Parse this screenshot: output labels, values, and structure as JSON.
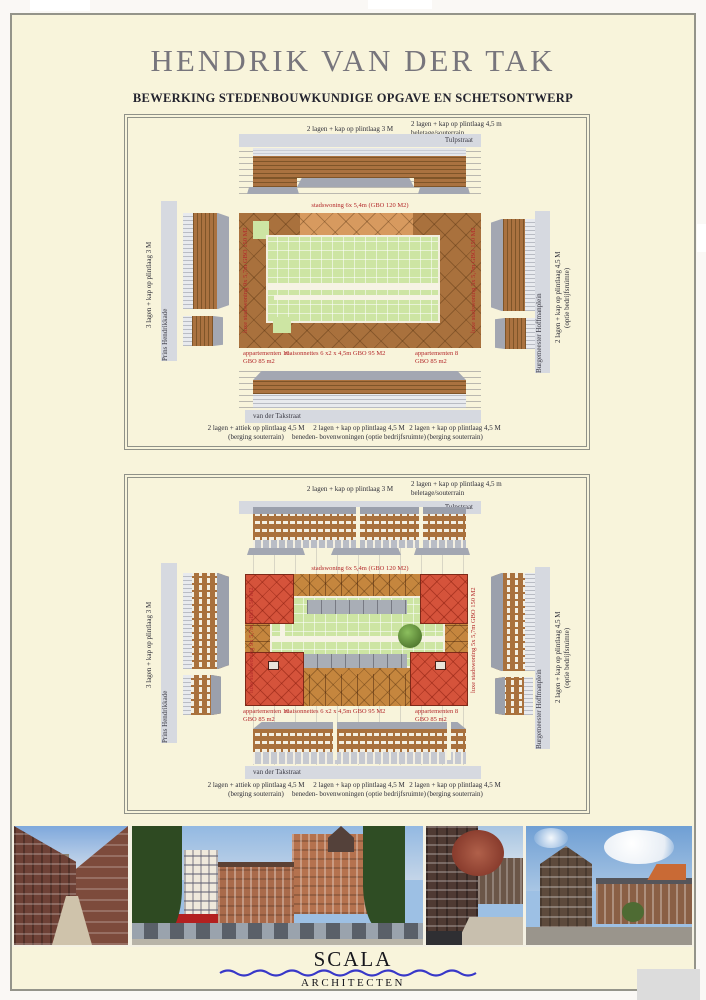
{
  "poster": {
    "title": "HENDRIK VAN DER TAK",
    "subtitle": "BEWERKING STEDENBOUWKUNDIGE OPGAVE EN SCHETSONTWERP"
  },
  "diagram1": {
    "top_center_label": "2 lagen + kap op plintlaag 3 M",
    "top_right_label_line1": "2 lagen + kap op plintlaag 4,5 m",
    "top_right_label_line2": "beletage/souterrain",
    "streets": {
      "north": "Tulpstraat",
      "west": "Prins Hendrikkade",
      "east": "Burgemeester Hoffmanplein",
      "south": "van der Takstraat"
    },
    "west_outer_label": "3 lagen + kap op plintlaag 3 M",
    "east_outer_label_line1": "2 lagen + kap op plintlaag 4,5 M",
    "east_outer_label_line2": "(optie bedrijfsruimte)",
    "program": {
      "north": "stadswoning 6x 5,4m (GBO 120 M2)",
      "west": "luxe stadswoning 9x 5,7m GBO 150 M2",
      "east": "luxe stadswoning 5x 5,7m GBO 150 M2",
      "south_left_line1": "appartementen 10",
      "south_left_line2": "GBO 85 m2",
      "south_center": "maisonnettes 6 x2 x 4,5m GBO 95 M2",
      "south_right_line1": "appartementen 8",
      "south_right_line2": "GBO 85 m2"
    },
    "bottom_left_line1": "2 lagen + attiek op plintlaag 4,5 M",
    "bottom_left_line2": "(berging souterrain)",
    "bottom_center_line1": "2 lagen + kap op plintlaag 4,5 M",
    "bottom_center_line2": "beneden- bovenwoningen (optie bedrijfsruimte)",
    "bottom_right_line1": "2 lagen + kap op plintlaag 4,5 M",
    "bottom_right_line2": "(berging souterrain)"
  },
  "diagram2": {
    "top_center_label": "2 lagen + kap op plintlaag 3 M",
    "top_right_label_line1": "2 lagen + kap op plintlaag 4,5 m",
    "top_right_label_line2": "beletage/souterrain",
    "streets": {
      "north": "Tulpstraat",
      "west": "Prins Hendrikkade",
      "east": "Burgemeester Hoffmanplein",
      "south": "van der Takstraat"
    },
    "west_outer_label": "3 lagen + kap op plintlaag 3 M",
    "east_outer_label_line1": "2 lagen + kap op plintlaag 4,5 M",
    "east_outer_label_line2": "(optie bedrijfsruimte)",
    "program": {
      "north": "stadswoning 6x 5,4m (GBO 120 M2)",
      "west": "luxe stadswoning 9x 5,7m GBO 150 M2",
      "east": "luxe stadswoning 5x 5,7m GBO 150 M2",
      "south_left_line1": "appartementen 10",
      "south_left_line2": "GBO 85 m2",
      "south_center": "maisonnettes 6 x2 x 4,5m GBO 95 M2",
      "south_right_line1": "appartementen 8",
      "south_right_line2": "GBO 85 m2"
    },
    "bottom_left_line1": "2 lagen + attiek op plintlaag 4,5 M",
    "bottom_left_line2": "(berging souterrain)",
    "bottom_center_line1": "2 lagen + kap op plintlaag 4,5 M",
    "bottom_center_line2": "beneden- bovenwoningen (optie bedrijfsruimte)",
    "bottom_right_line1": "2 lagen + kap op plintlaag 4,5 M",
    "bottom_right_line2": "(berging souterrain)"
  },
  "footer": {
    "logo_text": "SCALA",
    "logo_subtext": "ARCHITECTEN"
  },
  "colors": {
    "page_background": "#f8f4db",
    "building_brown": "#a9713d",
    "building_orange": "#d79a5f",
    "plan_red_block": "#d5533b",
    "courtyard_green": "#cde5a3",
    "street_gray": "#d6d9e0",
    "roof_gray": "#a3a7b2",
    "program_label_red": "#b3282a",
    "logo_blue": "#3838c8"
  }
}
